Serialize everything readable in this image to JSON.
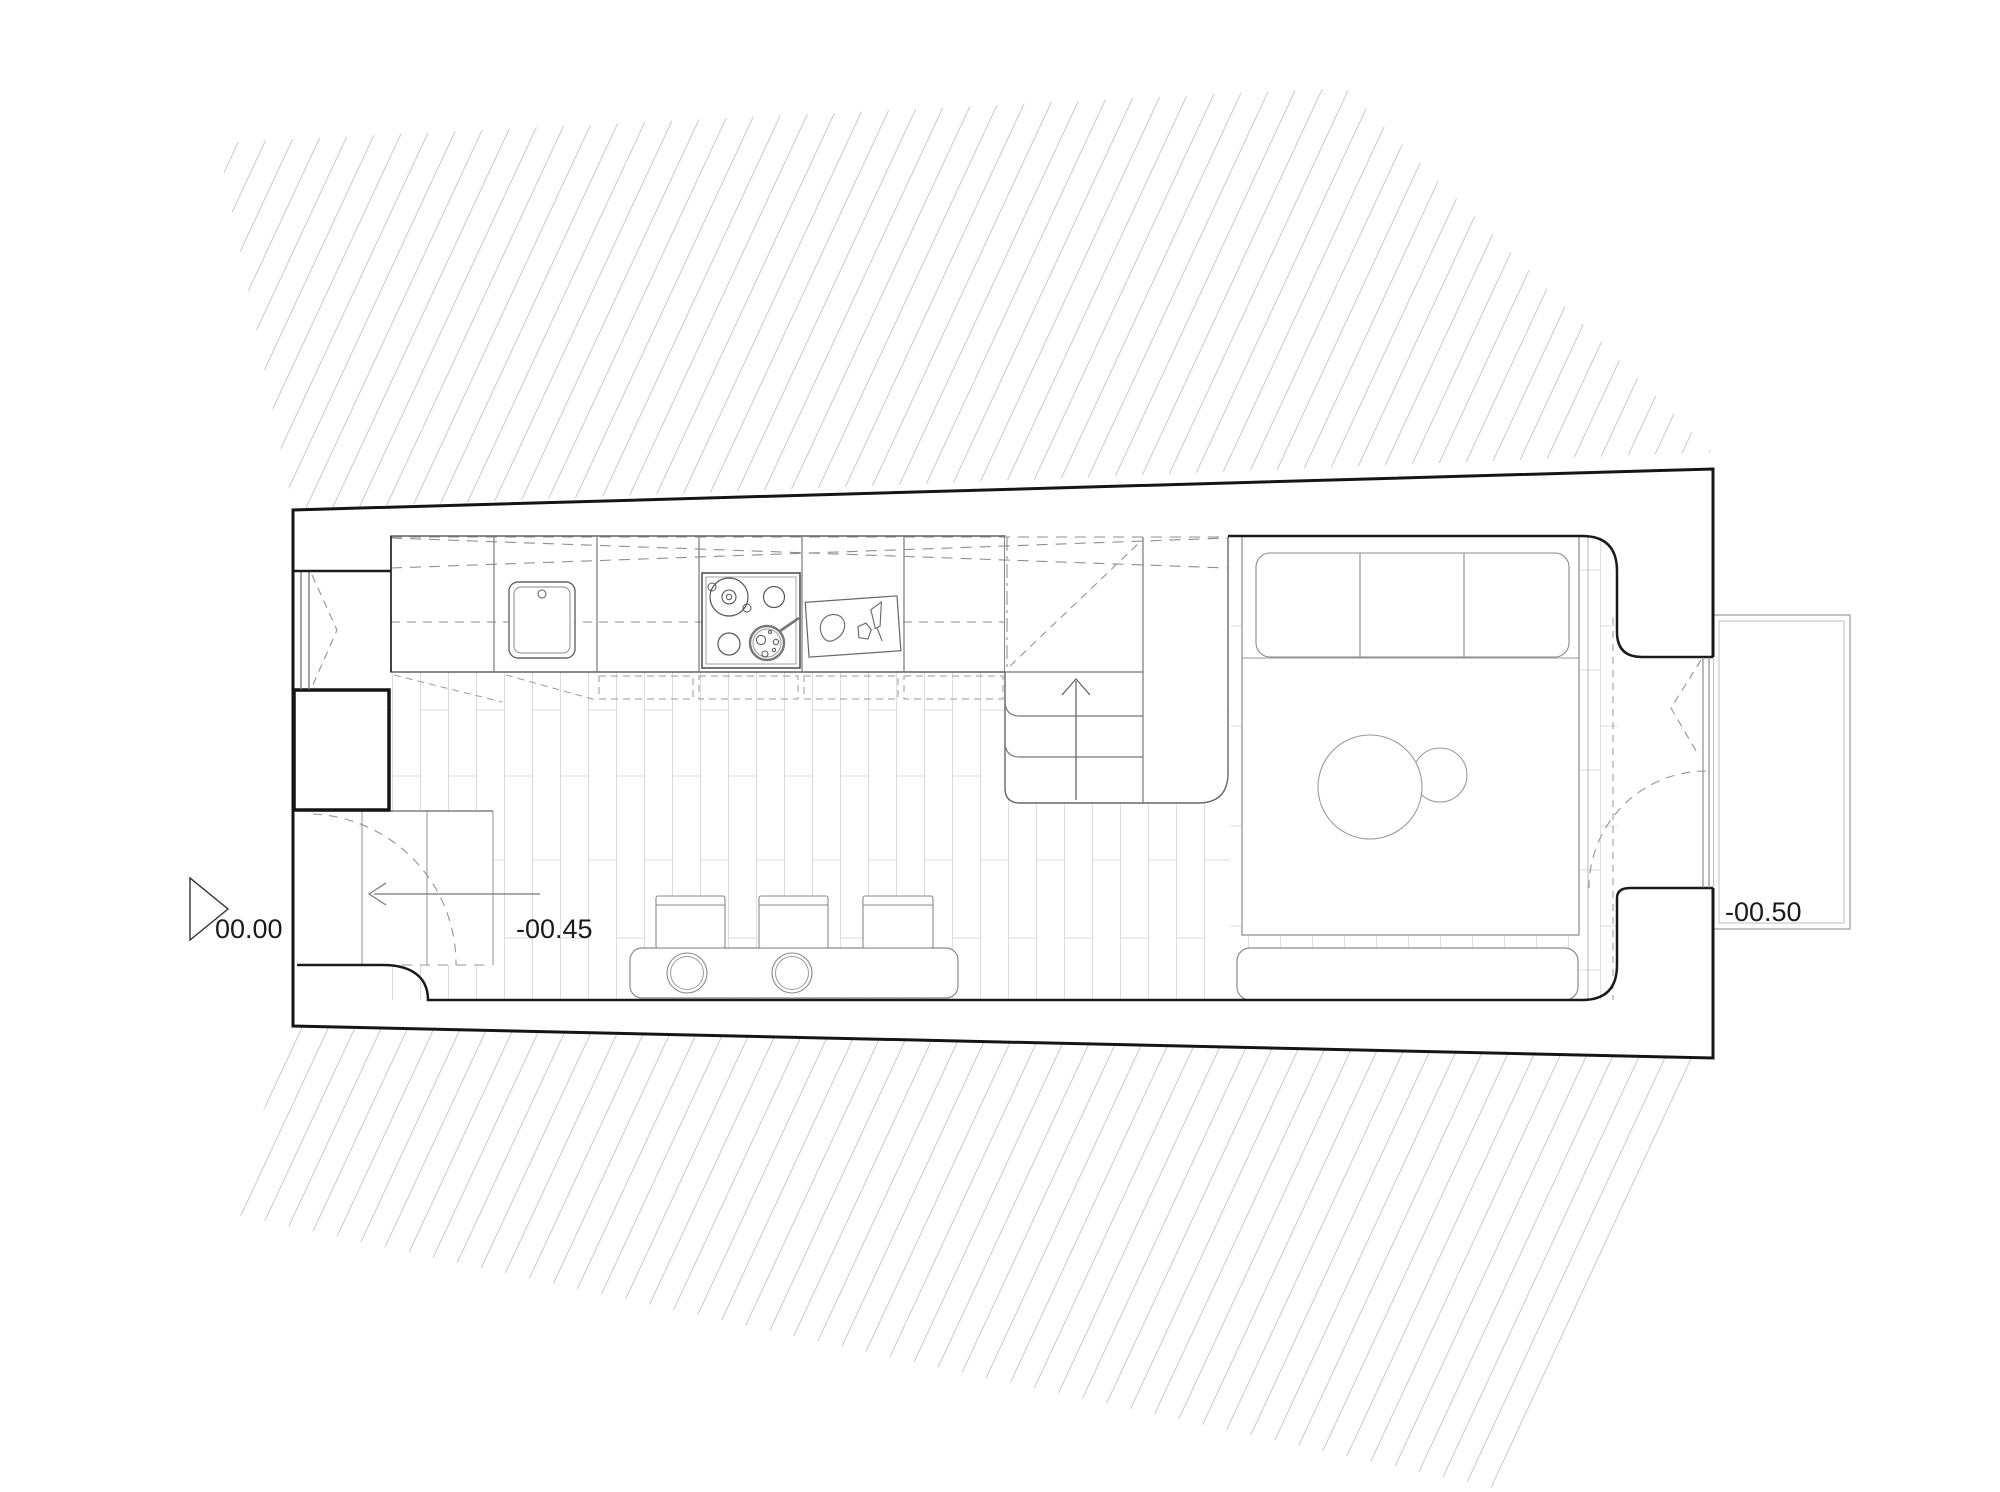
{
  "drawing": {
    "type": "architectural-floor-plan",
    "view": "studio apartment plan with kitchen, stairs, bed and terrace"
  },
  "labels": {
    "entry_level": "00.00",
    "living_level": "-00.45",
    "terrace_level": "-00.50"
  },
  "symbols": {
    "level_marker": "triangle-benchmark",
    "stair_direction": "arrow-up",
    "entry_direction": "arrow-left",
    "door_swings": "dashed-arcs",
    "upper_cabinets": "dashed-cross",
    "site_boundary": "diagonal-hatch"
  },
  "colors": {
    "background": "#ffffff",
    "wall_line": "#1b1b1b",
    "furniture_line": "#8a8a8a",
    "fixture_line": "#666666",
    "dashed_line": "#949494",
    "floor_joint": "#dcdcdc",
    "hatch": "#c9c9c9",
    "text": "#1a1a1a"
  }
}
